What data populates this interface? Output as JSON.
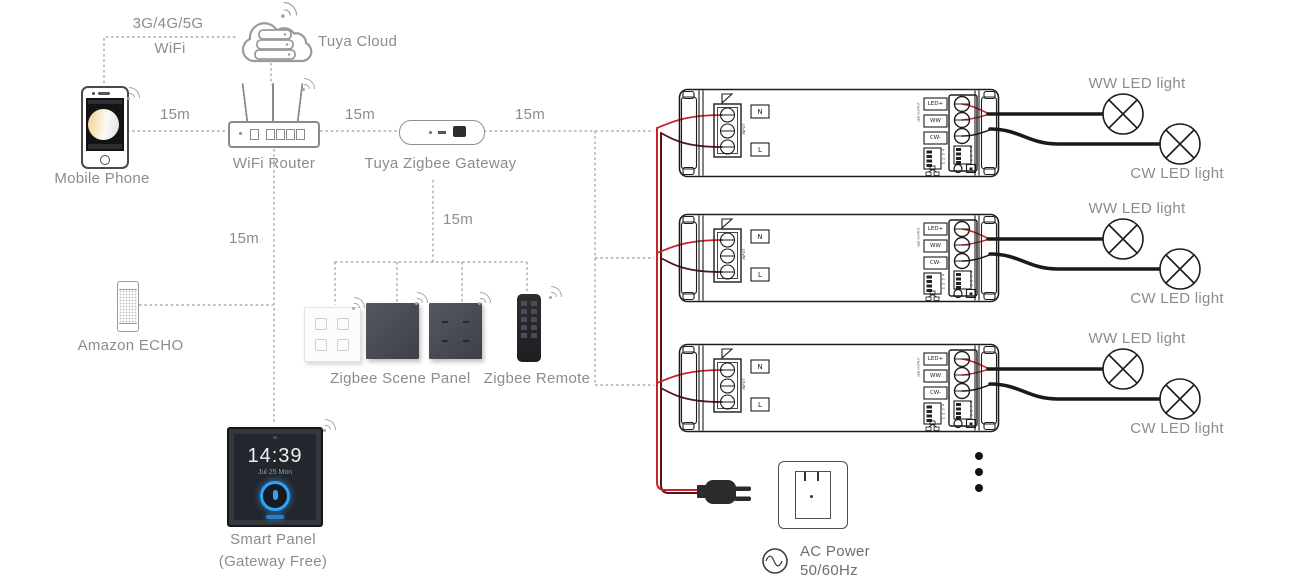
{
  "cloud": {
    "label": "Tuya Cloud"
  },
  "phone": {
    "label": "Mobile Phone"
  },
  "network": {
    "line1": "3G/4G/5G",
    "line2": "WiFi"
  },
  "router": {
    "label": "WiFi Router"
  },
  "gateway": {
    "label": "Tuya Zigbee Gateway"
  },
  "echo": {
    "label": "Amazon ECHO"
  },
  "scene_panel": {
    "label": "Zigbee Scene Panel"
  },
  "remote": {
    "label": "Zigbee Remote"
  },
  "smart_panel": {
    "label_line1": "Smart Panel",
    "label_line2": "(Gateway Free)",
    "time": "14:39",
    "date": "Jul 25 Mon"
  },
  "distances": {
    "phone_to_router": "15m",
    "router_to_gateway": "15m",
    "gateway_to_controllers": "15m",
    "router_to_smart_panel": "15m",
    "gateway_to_scene_devices": "15m"
  },
  "controller": {
    "n_label": "N",
    "l_label": "L",
    "input_label": "INPUT",
    "output_label": "LED OUTPUT",
    "out1_label": "LED+",
    "out2_label": "WW",
    "out3_label": "CW-",
    "dip_numbers": "1 2 3 4"
  },
  "lights": {
    "ww_label": "WW LED light",
    "cw_label": "CW LED light"
  },
  "power": {
    "line1": "AC Power",
    "line2": "50/60Hz"
  },
  "colors": {
    "wire_red": "#c8232b",
    "wire_dark": "#551417",
    "dashed_gray": "#9a9a9a",
    "label_gray": "#8c8c8c",
    "panel_blue": "#2da4f8"
  }
}
